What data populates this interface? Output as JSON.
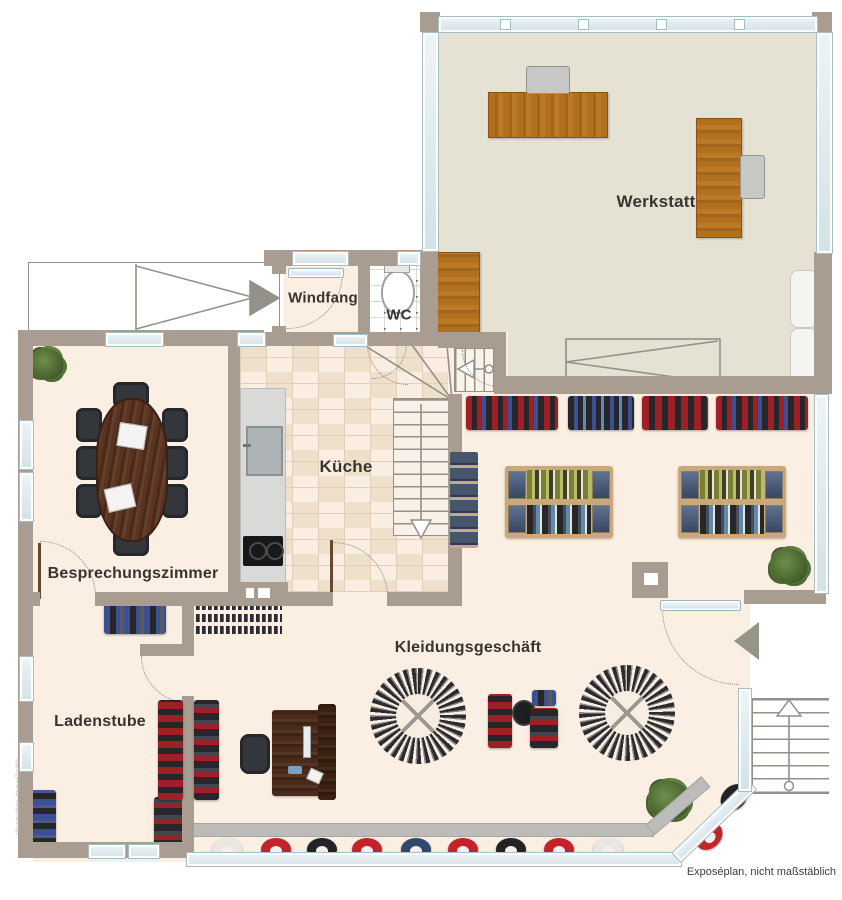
{
  "plan": {
    "footer_note": "Exposéplan, nicht maßstäblich",
    "watermark": "Illustration ImmoGrafik"
  },
  "rooms": {
    "werkstatt": "Werkstatt",
    "windfang": "Windfang",
    "wc": "WC",
    "kueche": "Küche",
    "besprechungszimmer": "Besprechungszimmer",
    "kleidungsgeschaeft": "Kleidungsgeschäft",
    "ladenstube": "Ladenstube"
  },
  "colors": {
    "wall": "#a89d90",
    "floor-cream": "#faefe2",
    "floor-werkstatt": "#e5e2d4",
    "tile": "#f6e7d5",
    "tile-line": "#e2cfb8",
    "glass": "#dce9ee",
    "glass-border": "#a7bcc3",
    "ink": "#3a3430",
    "line": "#94908a",
    "wood": "#b06f1e",
    "wood-dark": "#8a5413",
    "table-wood": "#532f1d",
    "desk-wood": "#47291a",
    "chair-dark": "#35383d",
    "chair-gray": "#c7c7c5",
    "c-red": "#9c2026",
    "c-black": "#26262b",
    "c-navy": "#3c4f93",
    "c-olive": "#7b7f33",
    "c-sky": "#5e8cb0",
    "c-tan": "#c9a97c",
    "plant": "#4c6a2e",
    "hat-white": "#e9e7e3",
    "hat-red": "#c3242a",
    "hat-black": "#232226",
    "hat-blue": "#30486b"
  },
  "shop": {
    "display_hats": [
      "hat-white",
      "hat-red",
      "hat-black",
      "hat-red",
      "hat-blue",
      "hat-red",
      "hat-black",
      "hat-red",
      "hat-white"
    ]
  }
}
